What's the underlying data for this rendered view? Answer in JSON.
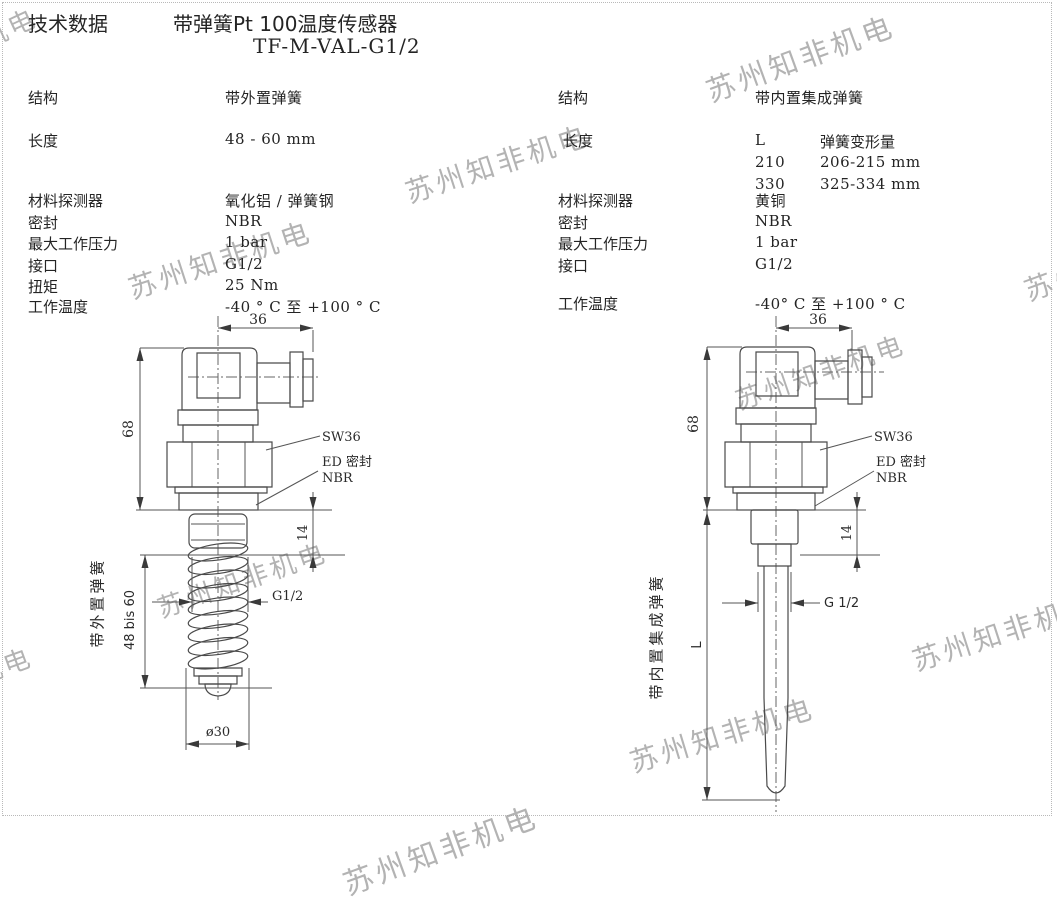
{
  "watermark": {
    "text": "苏州知非机电"
  },
  "header": {
    "doc_type": "技术数据",
    "title": "带弹簧Pt 100温度传感器",
    "model": "TF-M-VAL-G1/2"
  },
  "specs_left": {
    "structure_label": "结构",
    "structure": "带外置弹簧",
    "length_label": "长度",
    "length": "48 - 60 mm",
    "material_label": "材料探测器",
    "material": "氧化铝 / 弹簧钢",
    "seal_label": "密封",
    "seal": "NBR",
    "pressure_label": "最大工作压力",
    "pressure": "1 bar",
    "port_label": "接口",
    "port": "G1/2",
    "torque_label": "扭矩",
    "torque": "25 Nm",
    "temp_label": "工作温度",
    "temp": "-40 ° C 至 +100 ° C"
  },
  "specs_right": {
    "structure_label": "结构",
    "structure": "带内置集成弹簧",
    "length_label": "长度",
    "length_table": {
      "col1_header": "L",
      "col2_header": "弹簧变形量",
      "row1_col1": "210",
      "row1_col2": "206-215 mm",
      "row2_col1": "330",
      "row2_col2": "325-334 mm"
    },
    "material_label": "材料探测器",
    "material": "黄铜",
    "seal_label": "密封",
    "seal": "NBR",
    "pressure_label": "最大工作压力",
    "pressure": "1 bar",
    "port_label": "接口",
    "port": "G1/2",
    "temp_label": "工作温度",
    "temp": "-40° C 至 +100 ° C"
  },
  "drawing_left": {
    "caption": "带外置弹簧",
    "dim_width": "36",
    "dim_height": "68",
    "dim_thread_len": "14",
    "dim_spring_len": "48 bis 60",
    "thread_label": "G1/2",
    "dim_diameter": "ø30",
    "wrench_label": "SW36",
    "seal_note_line1": "ED 密封",
    "seal_note_line2": "NBR"
  },
  "drawing_right": {
    "caption": "带内置集成弹簧",
    "dim_width": "36",
    "dim_height": "68",
    "dim_thread_len": "14",
    "dim_probe_len": "L",
    "thread_label": "G 1/2",
    "wrench_label": "SW36",
    "seal_note_line1": "ED 密封",
    "seal_note_line2": "NBR"
  }
}
